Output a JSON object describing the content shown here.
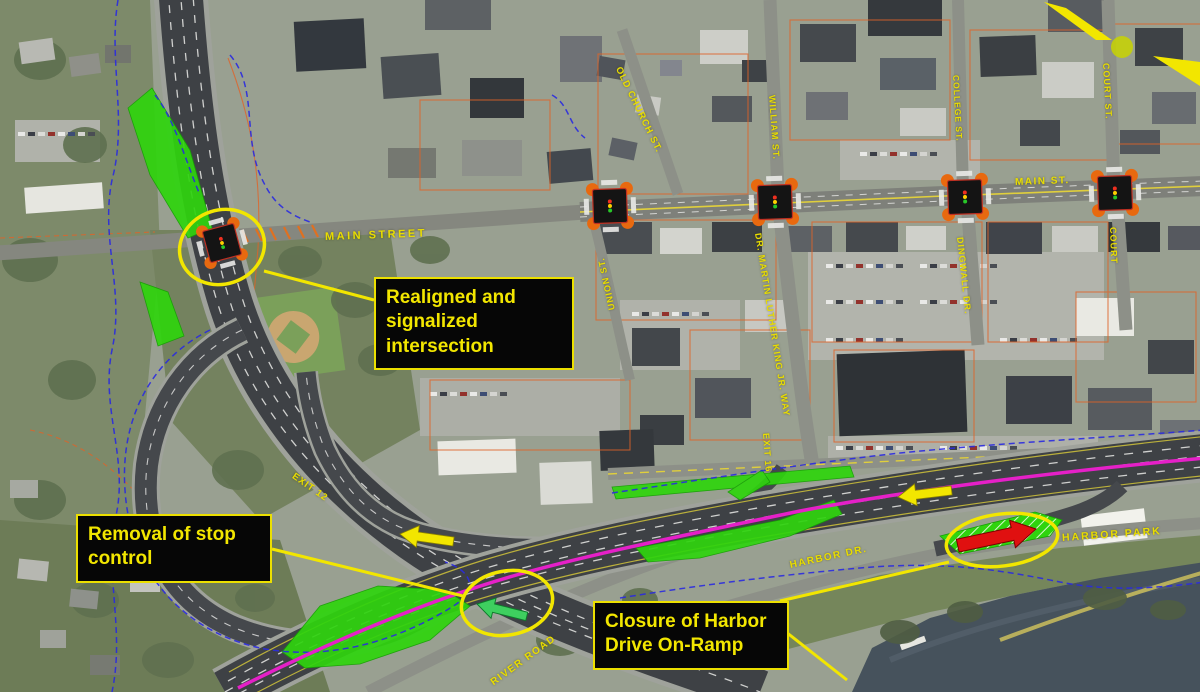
{
  "map": {
    "description": "Annotated aerial plan of Route 9 corridor improvements at Main Street and Harbor Park",
    "callouts": {
      "realigned": {
        "text": "Realigned and signalized intersection"
      },
      "stop_control": {
        "text": "Removal of stop control"
      },
      "harbor_closure": {
        "text": "Closure of Harbor Drive On-Ramp"
      }
    },
    "street_labels": [
      {
        "id": "main-street",
        "text": "MAIN STREET"
      },
      {
        "id": "main-st",
        "text": "MAIN ST."
      },
      {
        "id": "old-church-st",
        "text": "OLD CHURCH ST."
      },
      {
        "id": "william-st",
        "text": "WILLIAM ST."
      },
      {
        "id": "college-st",
        "text": "COLLEGE ST."
      },
      {
        "id": "court-st",
        "text": "COURT ST."
      },
      {
        "id": "court",
        "text": "COURT"
      },
      {
        "id": "union-st",
        "text": "UNION ST."
      },
      {
        "id": "mlk-way",
        "text": "DR. MARTIN LUTHER KING JR. WAY"
      },
      {
        "id": "dingwall-dr",
        "text": "DINGWALL DR."
      },
      {
        "id": "exit-12",
        "text": "EXIT 12"
      },
      {
        "id": "exit-16",
        "text": "EXIT 16"
      },
      {
        "id": "harbor-dr",
        "text": "HARBOR DR."
      },
      {
        "id": "harbor-park",
        "text": "HARBOR PARK"
      },
      {
        "id": "river-road",
        "text": "RIVER ROAD"
      }
    ],
    "legend_colors": {
      "annotation_yellow": "#f2e600",
      "callout_background": "#060606",
      "green_area": "#2fd40e",
      "route_magenta": "#e520c8",
      "flood_line_blue": "#2a2ae0",
      "parcel_line_orange": "#e06328",
      "closed_ramp_red": "#e01010",
      "new_flow_green": "#3ecf5f"
    }
  }
}
